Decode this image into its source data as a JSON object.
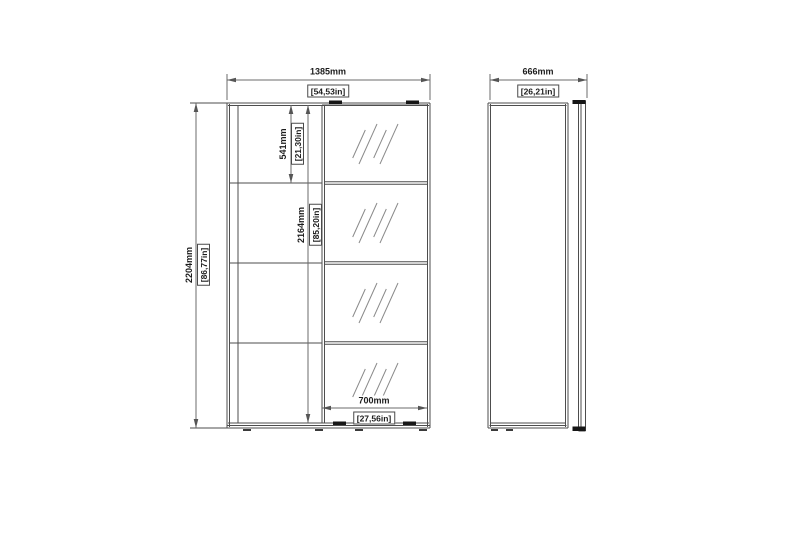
{
  "drawing": {
    "front_view": {
      "overall_width": {
        "mm": "1385mm",
        "in": "[54,53in]"
      },
      "overall_height": {
        "mm": "2204mm",
        "in": "[86,77in]"
      },
      "top_section_height": {
        "mm": "541mm",
        "in": "[21,30in]"
      },
      "interior_height": {
        "mm": "2164mm",
        "in": "[85,20in]"
      },
      "door_width": {
        "mm": "700mm",
        "in": "[27,56in]"
      }
    },
    "side_view": {
      "overall_depth": {
        "mm": "666mm",
        "in": "[26,21in]"
      }
    },
    "colors": {
      "background": "#ffffff",
      "outline": "#4d4d4d",
      "dimension_line": "#6b6b6b",
      "hatch": "#8a8a8a",
      "roller_mark": "#161616",
      "text": "#1c1c1c"
    }
  }
}
